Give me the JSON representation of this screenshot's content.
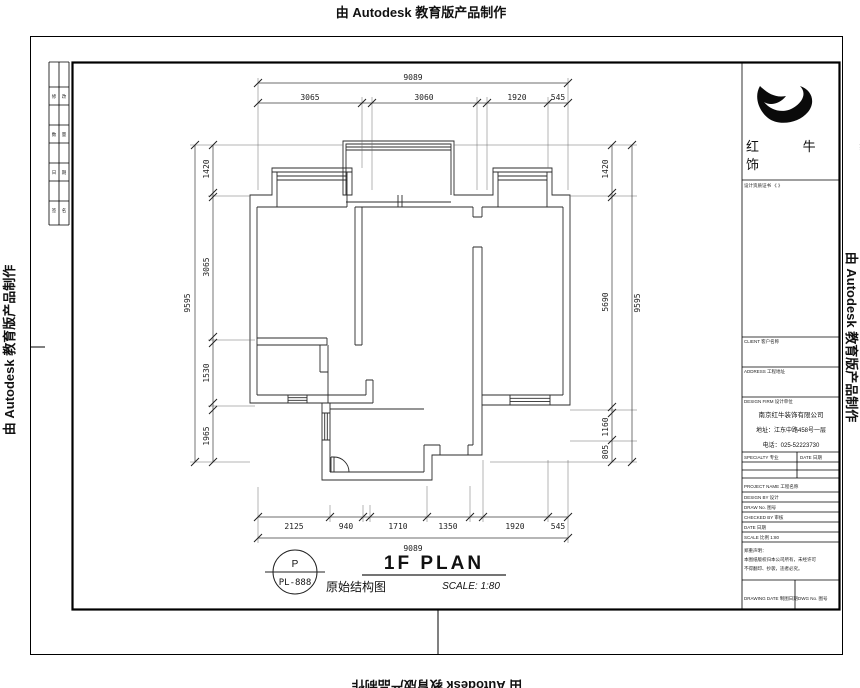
{
  "watermarks": {
    "top": "由 Autodesk 教育版产品制作",
    "bottom": "由 Autodesk 教育版产品制作",
    "left": "由 Autodesk 教育版产品制作",
    "right": "由 Autodesk 教育版产品制作"
  },
  "plan_title": {
    "letter": "P",
    "sheet_no": "PL-888",
    "title_en": "1F PLAN",
    "title_cn": "原始结构图",
    "scale": "SCALE: 1:80"
  },
  "dimensions": {
    "top": {
      "overall": "9089",
      "segments": [
        "3065",
        "3060",
        "1920",
        "545"
      ]
    },
    "bottom": {
      "overall": "9089",
      "segments": [
        "2125",
        "940",
        "1710",
        "1350",
        "1920",
        "545"
      ]
    },
    "left": {
      "overall": "9595",
      "segments": [
        "1420",
        "3065",
        "1530",
        "1965"
      ]
    },
    "right": {
      "overall": "9595",
      "segments": [
        "1420",
        "5690",
        "1160",
        "805"
      ]
    }
  },
  "title_block": {
    "logo_line1": "红 牛 装",
    "logo_line2": "饰",
    "cert_row": "设计资质证书 《 》",
    "client_row": "CLIENT 客户名称",
    "address_row": "ADDRESS 工程地址",
    "firm_row": "DESIGN FIRM 设计单位",
    "company_name": "南京红牛装饰有限公司",
    "company_address": "地址：江东中路458号一层",
    "company_phone": "电话：025-52223730",
    "col_specialty": "SPECIALTY 专业",
    "col_date": "DATE 日期",
    "rows": [
      {
        "label": "PROJECT NAME 工程名称"
      },
      {
        "label": "DESIGN BY 设计"
      },
      {
        "label": "DRAW No. 图号"
      },
      {
        "label": "CHECKED BY 审核"
      },
      {
        "label": "DATE 日期"
      },
      {
        "label": "SCALE 比例 1:80"
      }
    ],
    "notes_1": "郑重声明：",
    "notes_2": "本图纸版权归本公司所有，未经许可",
    "notes_3": "不得翻印、抄袭，违者必究。",
    "footer_left": "DRAWING DATE 制图日期",
    "footer_right": "DWG No. 图号"
  },
  "margin_strip": {
    "cells": [
      "修",
      "改",
      "数",
      "量",
      "日",
      "期",
      "签",
      "名"
    ]
  }
}
